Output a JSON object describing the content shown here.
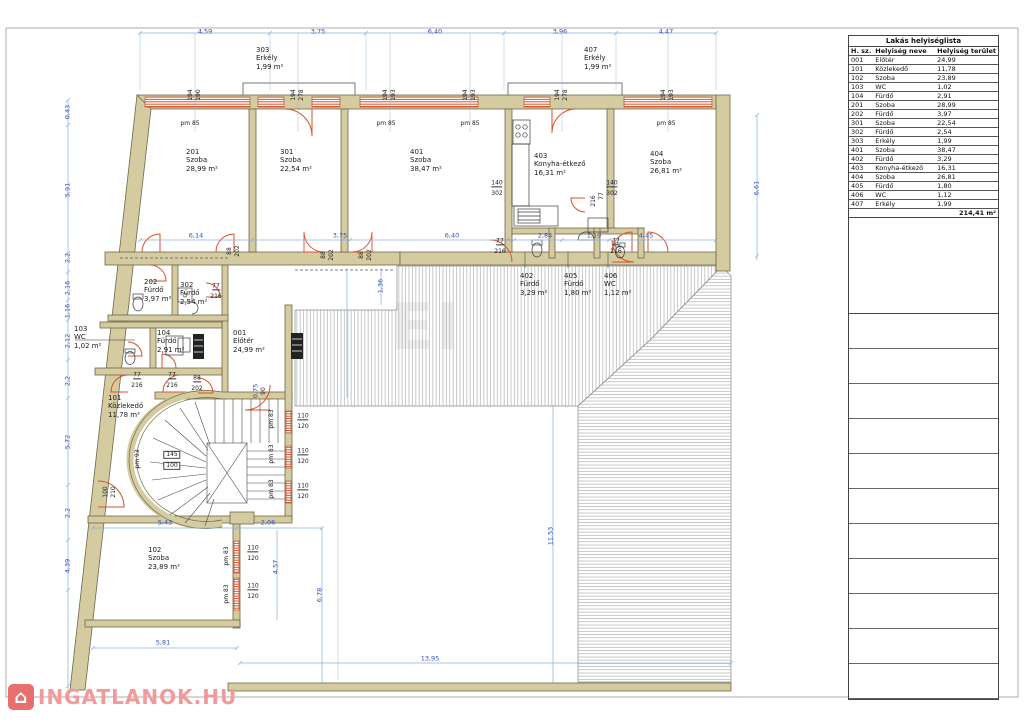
{
  "table": {
    "title": "Lakás helyiséglista",
    "headers": [
      "H. sz.",
      "Helyiség neve",
      "Helyiség terület"
    ],
    "rows": [
      [
        "001",
        "Előtér",
        "24,99"
      ],
      [
        "101",
        "Közlekedő",
        "11,78"
      ],
      [
        "102",
        "Szoba",
        "23,89"
      ],
      [
        "103",
        "WC",
        "1,02"
      ],
      [
        "104",
        "Fürdő",
        "2,91"
      ],
      [
        "201",
        "Szoba",
        "28,99"
      ],
      [
        "202",
        "Fürdő",
        "3,97"
      ],
      [
        "301",
        "Szoba",
        "22,54"
      ],
      [
        "302",
        "Fürdő",
        "2,54"
      ],
      [
        "303",
        "Erkély",
        "1,99"
      ],
      [
        "401",
        "Szoba",
        "38,47"
      ],
      [
        "402",
        "Fürdő",
        "3,29"
      ],
      [
        "403",
        "Konyha-étkező",
        "16,31"
      ],
      [
        "404",
        "Szoba",
        "26,81"
      ],
      [
        "405",
        "Fürdő",
        "1,80"
      ],
      [
        "406",
        "WC",
        "1,12"
      ],
      [
        "407",
        "Erkély",
        "1,99"
      ]
    ],
    "total": "214,41 m²",
    "empty_rows": 11
  },
  "watermark": {
    "logo_text": "INGATLANOK.HU",
    "logo_icon": "house-icon",
    "center_text": "EI"
  },
  "colors": {
    "wall": "#d5cba0",
    "window": "#dd4f28",
    "dim": "#2e4fc4",
    "logo": "#f29a9a"
  },
  "plan": {
    "labels": [
      {
        "t": "303\nErkély\n1,99 m²",
        "x": 256,
        "y": 46,
        "c": "r",
        "n": "room-label-303"
      },
      {
        "t": "407\nErkély\n1,99 m²",
        "x": 584,
        "y": 46,
        "c": "r",
        "n": "room-label-407"
      },
      {
        "t": "201\nSzoba\n28,99 m²",
        "x": 186,
        "y": 148,
        "c": "r",
        "n": "room-label-201"
      },
      {
        "t": "301\nSzoba\n22,54 m²",
        "x": 280,
        "y": 148,
        "c": "r",
        "n": "room-label-301"
      },
      {
        "t": "401\nSzoba\n38,47 m²",
        "x": 410,
        "y": 148,
        "c": "r",
        "n": "room-label-401"
      },
      {
        "t": "403\nKonyha-étkező\n16,31 m²",
        "x": 534,
        "y": 152,
        "c": "r",
        "n": "room-label-403"
      },
      {
        "t": "404\nSzoba\n26,81 m²",
        "x": 650,
        "y": 150,
        "c": "r",
        "n": "room-label-404"
      },
      {
        "t": "402\nFürdő\n3,29 m²",
        "x": 520,
        "y": 272,
        "c": "r",
        "n": "room-label-402"
      },
      {
        "t": "405\nFürdő\n1,80 m²",
        "x": 564,
        "y": 272,
        "c": "r",
        "n": "room-label-405"
      },
      {
        "t": "406\nWC\n1,12 m²",
        "x": 604,
        "y": 272,
        "c": "r",
        "n": "room-label-406"
      },
      {
        "t": "202\nFürdő\n3,97 m²",
        "x": 144,
        "y": 278,
        "c": "r",
        "n": "room-label-202"
      },
      {
        "t": "302\nFürdő\n2,54 m²",
        "x": 180,
        "y": 281,
        "c": "r",
        "n": "room-label-302"
      },
      {
        "t": "103\nWC\n1,02 m²",
        "x": 74,
        "y": 325,
        "c": "r",
        "n": "room-label-103"
      },
      {
        "t": "104\nFürdő\n2,91 m²",
        "x": 157,
        "y": 329,
        "c": "r",
        "n": "room-label-104"
      },
      {
        "t": "001\nElőtér\n24,99 m²",
        "x": 233,
        "y": 329,
        "c": "r",
        "n": "room-label-001"
      },
      {
        "t": "101\nKözlekedő\n11,78 m²",
        "x": 108,
        "y": 394,
        "c": "r",
        "n": "room-label-101"
      },
      {
        "t": "102\nSzoba\n23,89 m²",
        "x": 148,
        "y": 546,
        "c": "r",
        "n": "room-label-102"
      },
      {
        "t": "4,59",
        "x": 205,
        "y": 32,
        "c": "d"
      },
      {
        "t": "3,75",
        "x": 318,
        "y": 32,
        "c": "d"
      },
      {
        "t": "6,40",
        "x": 435,
        "y": 32,
        "c": "d"
      },
      {
        "t": "3,96",
        "x": 560,
        "y": 32,
        "c": "d"
      },
      {
        "t": "4,47",
        "x": 666,
        "y": 32,
        "c": "d"
      },
      {
        "t": "6,14",
        "x": 196,
        "y": 236,
        "c": "d"
      },
      {
        "t": "3,75",
        "x": 340,
        "y": 236,
        "c": "d"
      },
      {
        "t": "6,40",
        "x": 452,
        "y": 236,
        "c": "d"
      },
      {
        "t": "2,84",
        "x": 545,
        "y": 236,
        "c": "d"
      },
      {
        "t": "1,19",
        "x": 594,
        "y": 236,
        "c": "d"
      },
      {
        "t": "4,45",
        "x": 646,
        "y": 236,
        "c": "d"
      },
      {
        "t": "5,43",
        "x": 165,
        "y": 523,
        "c": "d"
      },
      {
        "t": "2,06",
        "x": 268,
        "y": 523,
        "c": "d"
      },
      {
        "t": "5,81",
        "x": 163,
        "y": 643,
        "c": "d"
      },
      {
        "t": "13,95",
        "x": 430,
        "y": 659,
        "c": "d"
      },
      {
        "t": "0,43",
        "x": 68,
        "y": 112,
        "c": "dv"
      },
      {
        "t": "5,91",
        "x": 68,
        "y": 190,
        "c": "dv"
      },
      {
        "t": "2,2",
        "x": 68,
        "y": 258,
        "c": "dv"
      },
      {
        "t": "2,16",
        "x": 68,
        "y": 288,
        "c": "dv"
      },
      {
        "t": "1,16",
        "x": 68,
        "y": 311,
        "c": "dv"
      },
      {
        "t": "2,12",
        "x": 68,
        "y": 341,
        "c": "dv"
      },
      {
        "t": "2,2",
        "x": 68,
        "y": 381,
        "c": "dv"
      },
      {
        "t": "5,72",
        "x": 68,
        "y": 442,
        "c": "dv"
      },
      {
        "t": "2,2",
        "x": 68,
        "y": 513,
        "c": "dv"
      },
      {
        "t": "4,39",
        "x": 68,
        "y": 566,
        "c": "dv"
      },
      {
        "t": "6,61",
        "x": 757,
        "y": 188,
        "c": "dv"
      },
      {
        "t": "11,53",
        "x": 551,
        "y": 536,
        "c": "dv"
      },
      {
        "t": "6,78",
        "x": 320,
        "y": 595,
        "c": "dv"
      },
      {
        "t": "4,57",
        "x": 276,
        "y": 567,
        "c": "dv"
      },
      {
        "t": "1,36",
        "x": 381,
        "y": 286,
        "c": "dv"
      },
      {
        "t": "0,75",
        "x": 256,
        "y": 391,
        "c": "dv"
      },
      {
        "t": "pm 85",
        "x": 190,
        "y": 124,
        "c": "t"
      },
      {
        "t": "pm 85",
        "x": 386,
        "y": 124,
        "c": "t"
      },
      {
        "t": "pm 85",
        "x": 470,
        "y": 124,
        "c": "t"
      },
      {
        "t": "pm 85",
        "x": 666,
        "y": 124,
        "c": "t"
      },
      {
        "t": "110",
        "x": 303,
        "y": 417,
        "c": "tu"
      },
      {
        "t": "120",
        "x": 303,
        "y": 427,
        "c": "t"
      },
      {
        "t": "110",
        "x": 303,
        "y": 452,
        "c": "tu"
      },
      {
        "t": "120",
        "x": 303,
        "y": 462,
        "c": "t"
      },
      {
        "t": "110",
        "x": 303,
        "y": 487,
        "c": "tu"
      },
      {
        "t": "120",
        "x": 303,
        "y": 497,
        "c": "t"
      },
      {
        "t": "110",
        "x": 253,
        "y": 549,
        "c": "tu"
      },
      {
        "t": "120",
        "x": 253,
        "y": 559,
        "c": "t"
      },
      {
        "t": "110",
        "x": 253,
        "y": 587,
        "c": "tu"
      },
      {
        "t": "120",
        "x": 253,
        "y": 597,
        "c": "t"
      },
      {
        "t": "140",
        "x": 497,
        "y": 184,
        "c": "tu"
      },
      {
        "t": "302",
        "x": 497,
        "y": 194,
        "c": "t"
      },
      {
        "t": "140",
        "x": 612,
        "y": 184,
        "c": "tu"
      },
      {
        "t": "302",
        "x": 612,
        "y": 194,
        "c": "t"
      },
      {
        "t": "77",
        "x": 500,
        "y": 242,
        "c": "tu"
      },
      {
        "t": "216",
        "x": 500,
        "y": 252,
        "c": "t"
      },
      {
        "t": "77",
        "x": 616,
        "y": 242,
        "c": "tu"
      },
      {
        "t": "216",
        "x": 616,
        "y": 252,
        "c": "t"
      },
      {
        "t": "77",
        "x": 137,
        "y": 376,
        "c": "tu"
      },
      {
        "t": "216",
        "x": 137,
        "y": 386,
        "c": "t"
      },
      {
        "t": "77",
        "x": 172,
        "y": 376,
        "c": "tu"
      },
      {
        "t": "216",
        "x": 172,
        "y": 386,
        "c": "t"
      },
      {
        "t": "88",
        "x": 197,
        "y": 379,
        "c": "tu"
      },
      {
        "t": "202",
        "x": 197,
        "y": 389,
        "c": "t"
      },
      {
        "t": "77",
        "x": 216,
        "y": 287,
        "c": "tu"
      },
      {
        "t": "216",
        "x": 216,
        "y": 297,
        "c": "t"
      },
      {
        "t": "pm 83",
        "x": 272,
        "y": 419,
        "c": "tv"
      },
      {
        "t": "pm 83",
        "x": 272,
        "y": 454,
        "c": "tv"
      },
      {
        "t": "pm 83",
        "x": 272,
        "y": 489,
        "c": "tv"
      },
      {
        "t": "pm 83",
        "x": 227,
        "y": 556,
        "c": "tv"
      },
      {
        "t": "pm 83",
        "x": 227,
        "y": 594,
        "c": "tv"
      },
      {
        "t": "pm 93",
        "x": 138,
        "y": 459,
        "c": "tv"
      },
      {
        "t": "194",
        "x": 191,
        "y": 95,
        "c": "tv"
      },
      {
        "t": "190",
        "x": 199,
        "y": 95,
        "c": "tv"
      },
      {
        "t": "194",
        "x": 294,
        "y": 95,
        "c": "tv"
      },
      {
        "t": "278",
        "x": 302,
        "y": 95,
        "c": "tv"
      },
      {
        "t": "194",
        "x": 386,
        "y": 95,
        "c": "tv"
      },
      {
        "t": "193",
        "x": 394,
        "y": 95,
        "c": "tv"
      },
      {
        "t": "194",
        "x": 466,
        "y": 95,
        "c": "tv"
      },
      {
        "t": "193",
        "x": 474,
        "y": 95,
        "c": "tv"
      },
      {
        "t": "194",
        "x": 558,
        "y": 95,
        "c": "tv"
      },
      {
        "t": "278",
        "x": 566,
        "y": 95,
        "c": "tv"
      },
      {
        "t": "194",
        "x": 664,
        "y": 95,
        "c": "tv"
      },
      {
        "t": "193",
        "x": 672,
        "y": 95,
        "c": "tv"
      },
      {
        "t": "88",
        "x": 230,
        "y": 251,
        "c": "tv"
      },
      {
        "t": "202",
        "x": 238,
        "y": 251,
        "c": "tv"
      },
      {
        "t": "88",
        "x": 324,
        "y": 255,
        "c": "tv"
      },
      {
        "t": "202",
        "x": 332,
        "y": 255,
        "c": "tv"
      },
      {
        "t": "88",
        "x": 362,
        "y": 255,
        "c": "tv"
      },
      {
        "t": "202",
        "x": 370,
        "y": 255,
        "c": "tv"
      },
      {
        "t": "90",
        "x": 264,
        "y": 391,
        "c": "tv"
      },
      {
        "t": "100",
        "x": 106,
        "y": 492,
        "c": "tv"
      },
      {
        "t": "210",
        "x": 114,
        "y": 492,
        "c": "tv"
      },
      {
        "t": "77",
        "x": 602,
        "y": 196,
        "c": "tv"
      },
      {
        "t": "216",
        "x": 594,
        "y": 201,
        "c": "tv"
      },
      {
        "t": "145",
        "x": 172,
        "y": 455,
        "c": "box"
      },
      {
        "t": "100",
        "x": 172,
        "y": 466,
        "c": "box"
      }
    ]
  }
}
